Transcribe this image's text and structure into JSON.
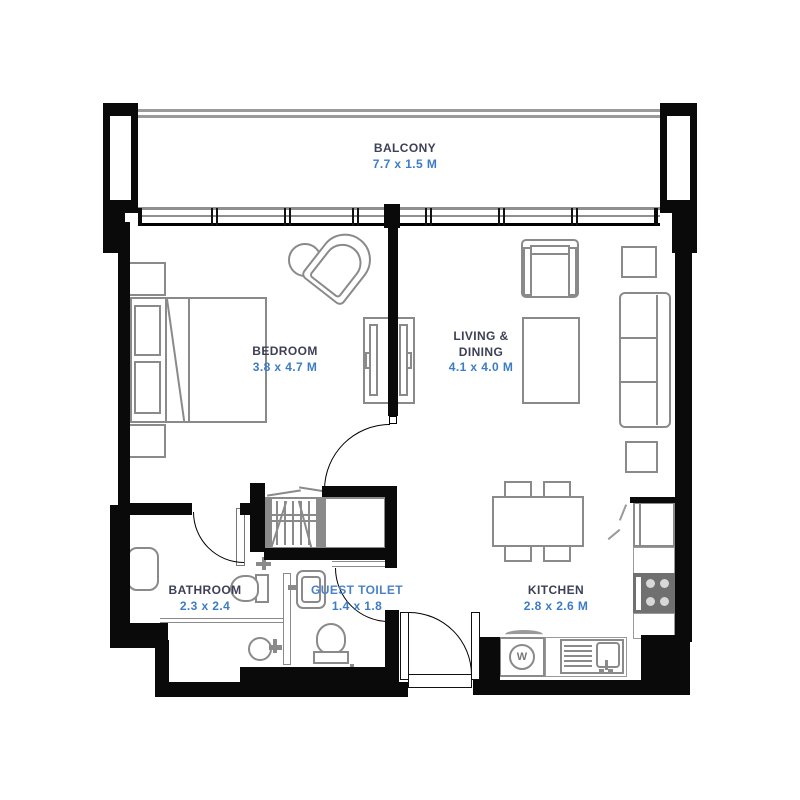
{
  "title": "Apartment Floor Plan",
  "colors": {
    "wall": "#0a0a0a",
    "furniture_line": "#8a8a8a",
    "room_name": "#3d4156",
    "dimension_text": "#3c7cc4",
    "background": "#ffffff"
  },
  "rooms": {
    "balcony": {
      "name": "BALCONY",
      "dims": "7.7 x 1.5 M"
    },
    "bedroom": {
      "name": "BEDROOM",
      "dims": "3.8 x 4.7 M"
    },
    "living_dining": {
      "name_line1": "LIVING &",
      "name_line2": "DINING",
      "dims": "4.1 x 4.0 M"
    },
    "bathroom": {
      "name": "BATHROOM",
      "dims": "2.3 x 2.4"
    },
    "guest_toilet": {
      "name": "GUEST TOILET",
      "dims": "1.4 x 1.8"
    },
    "kitchen": {
      "name": "KITCHEN",
      "dims": "2.8 x 2.6 M"
    }
  },
  "appliances": {
    "washer_label": "W"
  },
  "icons": [
    "bed",
    "pillow",
    "nightstand",
    "stool",
    "accent-chair",
    "tv-console",
    "armchair",
    "coffee-table",
    "sofa",
    "side-table",
    "dining-table",
    "dining-chair",
    "wardrobe-hangers",
    "bathtub-vanity",
    "toilet",
    "shower-drain",
    "hand-wash-basin",
    "fridge",
    "stove-hob",
    "washing-machine",
    "kitchen-sink",
    "door-swing",
    "window-band",
    "balcony-railing"
  ]
}
